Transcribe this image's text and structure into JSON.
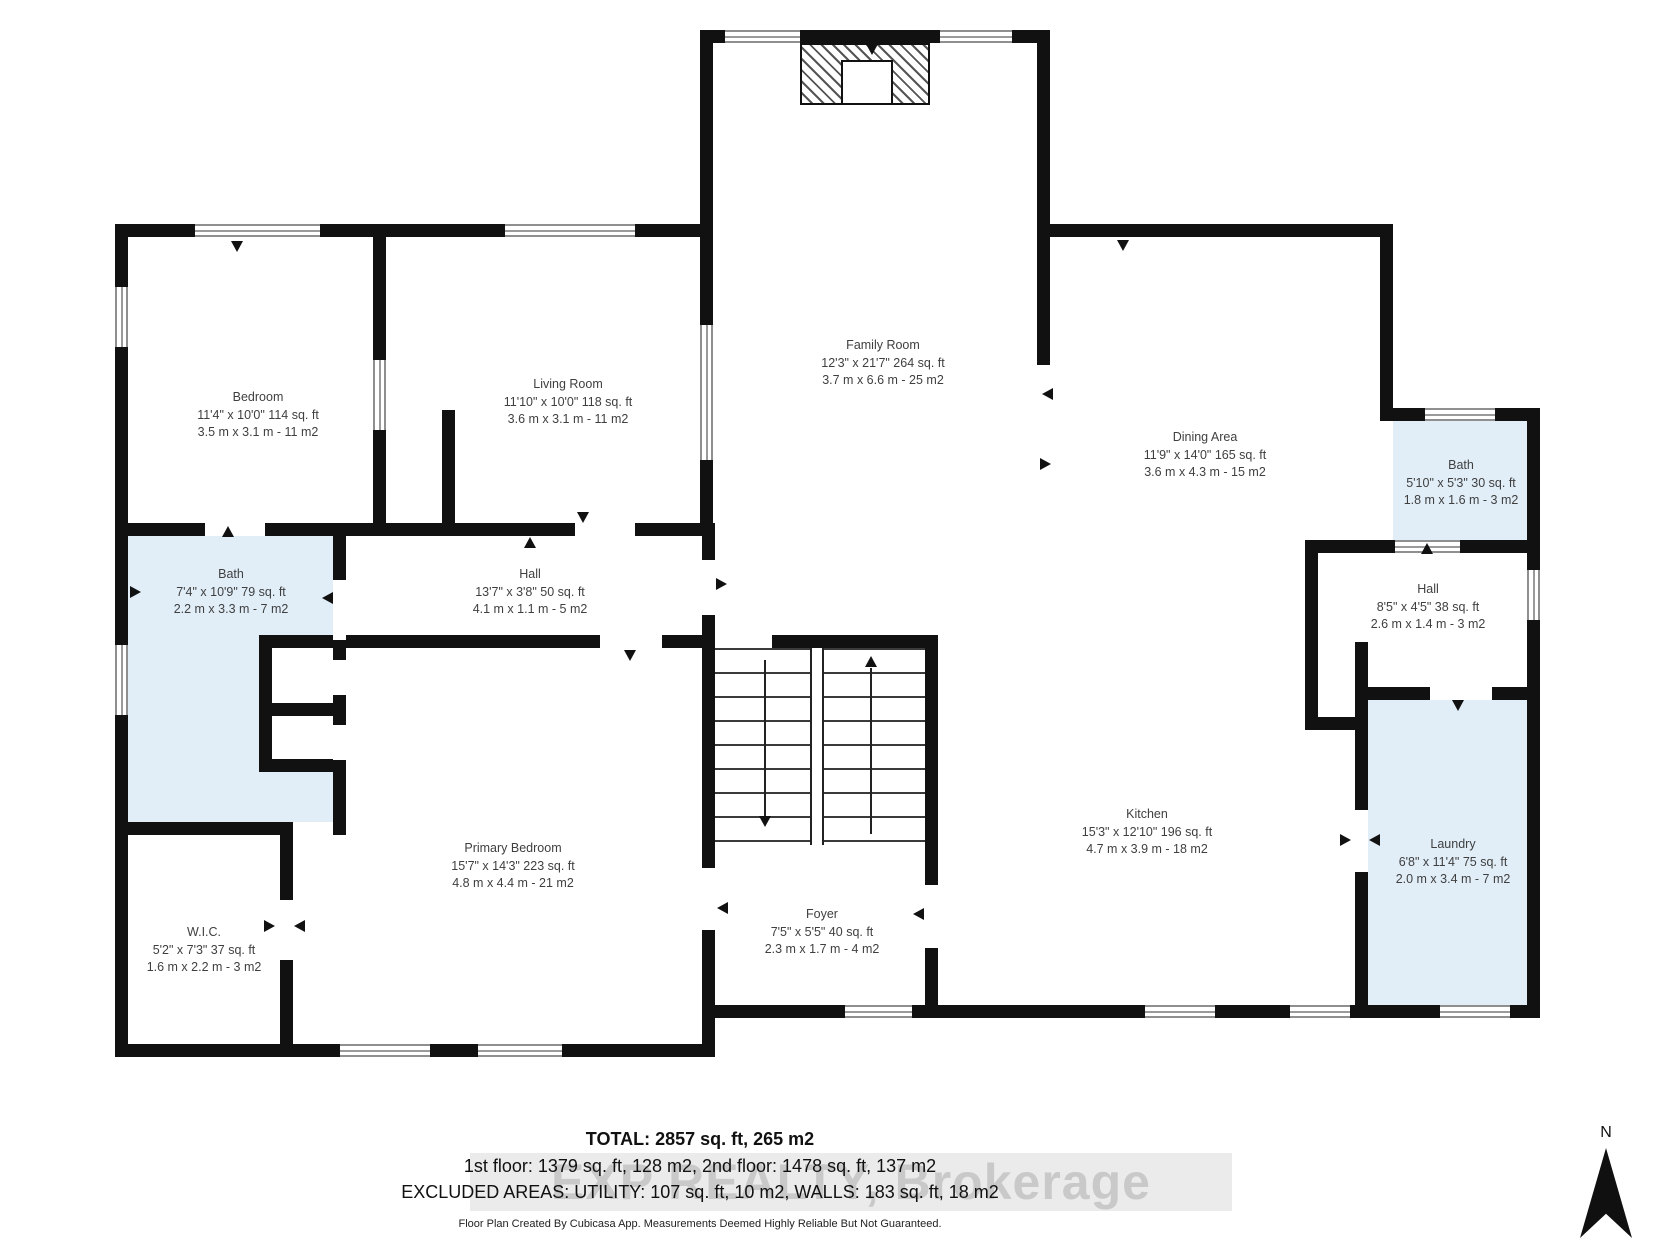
{
  "plan": {
    "rooms": {
      "bedroom": {
        "name": "Bedroom",
        "imperial": "11'4\" x 10'0\" 114 sq. ft",
        "metric": "3.5 m x 3.1 m - 11 m2"
      },
      "living_room": {
        "name": "Living Room",
        "imperial": "11'10\" x 10'0\" 118 sq. ft",
        "metric": "3.6 m x 3.1 m - 11 m2"
      },
      "family_room": {
        "name": "Family Room",
        "imperial": "12'3\" x 21'7\" 264 sq. ft",
        "metric": "3.7 m x 6.6 m - 25 m2"
      },
      "dining_area": {
        "name": "Dining Area",
        "imperial": "11'9\" x 14'0\" 165 sq. ft",
        "metric": "3.6 m x 4.3 m - 15 m2"
      },
      "bath_upper": {
        "name": "Bath",
        "imperial": "5'10\" x 5'3\" 30 sq. ft",
        "metric": "1.8 m x 1.6 m - 3 m2"
      },
      "hall_right": {
        "name": "Hall",
        "imperial": "8'5\" x 4'5\" 38 sq. ft",
        "metric": "2.6 m x 1.4 m - 3 m2"
      },
      "hall_left": {
        "name": "Hall",
        "imperial": "13'7\" x 3'8\" 50 sq. ft",
        "metric": "4.1 m x 1.1 m - 5 m2"
      },
      "bath_left": {
        "name": "Bath",
        "imperial": "7'4\" x 10'9\" 79 sq. ft",
        "metric": "2.2 m x 3.3 m - 7 m2"
      },
      "primary_bedroom": {
        "name": "Primary Bedroom",
        "imperial": "15'7\" x 14'3\" 223 sq. ft",
        "metric": "4.8 m x 4.4 m - 21 m2"
      },
      "wic": {
        "name": "W.I.C.",
        "imperial": "5'2\" x 7'3\" 37 sq. ft",
        "metric": "1.6 m x 2.2 m - 3 m2"
      },
      "foyer": {
        "name": "Foyer",
        "imperial": "7'5\" x 5'5\" 40 sq. ft",
        "metric": "2.3 m x 1.7 m - 4 m2"
      },
      "kitchen": {
        "name": "Kitchen",
        "imperial": "15'3\" x 12'10\" 196 sq. ft",
        "metric": "4.7 m x 3.9 m - 18 m2"
      },
      "laundry": {
        "name": "Laundry",
        "imperial": "6'8\" x 11'4\" 75 sq. ft",
        "metric": "2.0 m x 3.4 m - 7 m2"
      }
    },
    "summary": {
      "total": "TOTAL: 2857 sq. ft, 265 m2",
      "floors": "1st floor: 1379 sq. ft, 128 m2, 2nd floor: 1478 sq. ft, 137 m2",
      "excluded": "EXCLUDED AREAS: UTILITY: 107 sq. ft, 10 m2, WALLS: 183 sq. ft, 18 m2",
      "disclaimer": "Floor Plan Created By Cubicasa App. Measurements Deemed Highly Reliable But Not Guaranteed."
    },
    "watermark": "EXP REALTY, Brokerage",
    "compass": {
      "label": "N"
    },
    "colors": {
      "wall": "#111111",
      "wet_room_fill": "#e1eef8",
      "label_text": "#3f3f3f",
      "watermark_text": "#c9c9c9"
    }
  }
}
